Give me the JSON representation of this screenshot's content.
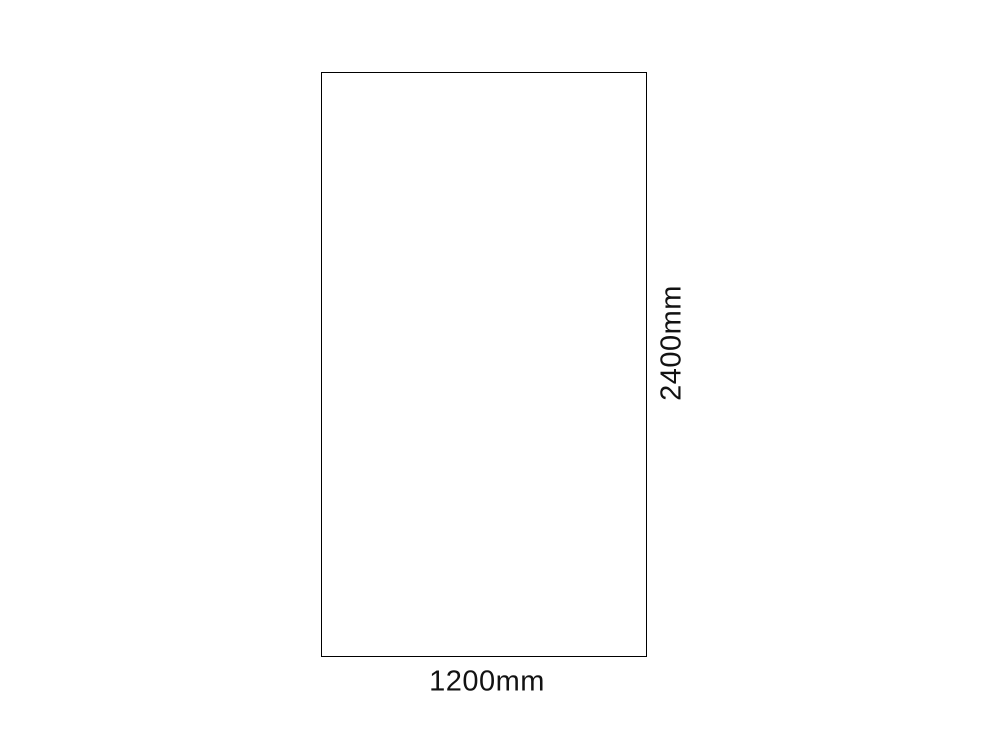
{
  "page": {
    "background_color": "#ffffff"
  },
  "diagram": {
    "type": "rectangle-dimension-diagram",
    "rectangle": {
      "border_color": "#000000",
      "fill_color": "#ffffff",
      "width_mm": 1200,
      "height_mm": 2400
    },
    "labels": {
      "width": "1200mm",
      "height": "2400mm"
    },
    "text_color": "#121212"
  }
}
